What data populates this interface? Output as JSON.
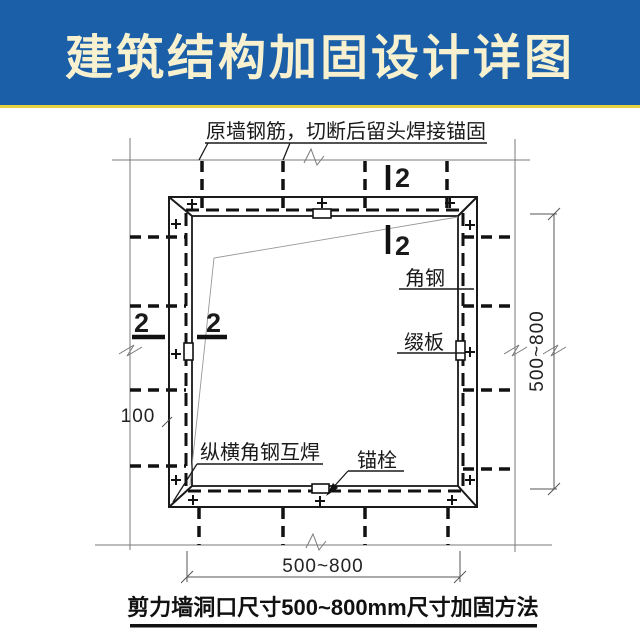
{
  "banner": {
    "title": "建筑结构加固设计详图",
    "bg_color": "#1a5fa8",
    "accent_line_color": "#e6d23e",
    "title_color": "#f7f1cf"
  },
  "drawing": {
    "labels": {
      "top_note": "原墙钢筋，切断后留头焊接锚固",
      "angle_steel": "角钢",
      "batten_plate": "缀板",
      "weld_note": "纵横角钢互焊",
      "anchor_bolt": "锚栓",
      "section_mark": "2",
      "rebar_spacing": "100",
      "opening_width": "500~800",
      "opening_height": "500~800"
    },
    "caption": "剪力墙洞口尺寸500~800mm尺寸加固方法"
  }
}
